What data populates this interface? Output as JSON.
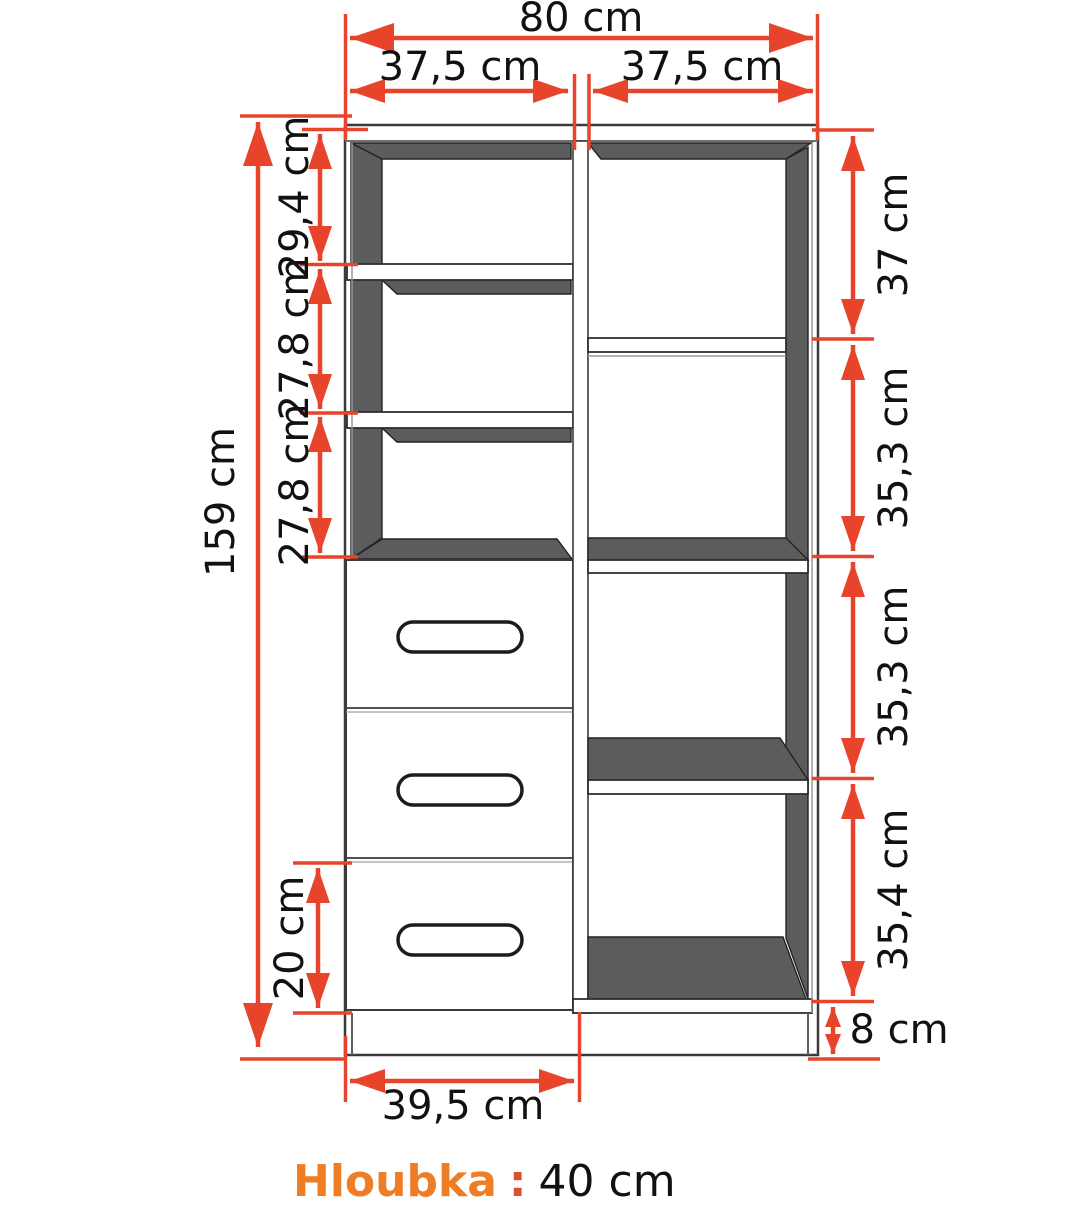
{
  "diagram": {
    "kind": "furniture-dimension-diagram",
    "colors": {
      "dimension_accent": "#e8432b",
      "depth_label_orange": "#ef7d26",
      "cabinet_dark_fill": "#5b5c5e"
    },
    "dims": {
      "total_width": "80 cm",
      "left_column_width": "37,5 cm",
      "right_column_width": "37,5 cm",
      "total_height": "159 cm",
      "left_section_1": "29,4 cm",
      "left_section_2": "27,8 cm",
      "left_section_3": "27,8 cm",
      "right_section_1": "37 cm",
      "right_section_2": "35,3 cm",
      "right_section_3": "35,3 cm",
      "right_section_4": "35,4 cm",
      "bottom_drawer_height": "20 cm",
      "plinth_height": "8 cm",
      "drawer_module_width": "39,5 cm"
    },
    "depth": {
      "label": "Hloubka",
      "separator": ":",
      "value": "40 cm"
    }
  }
}
